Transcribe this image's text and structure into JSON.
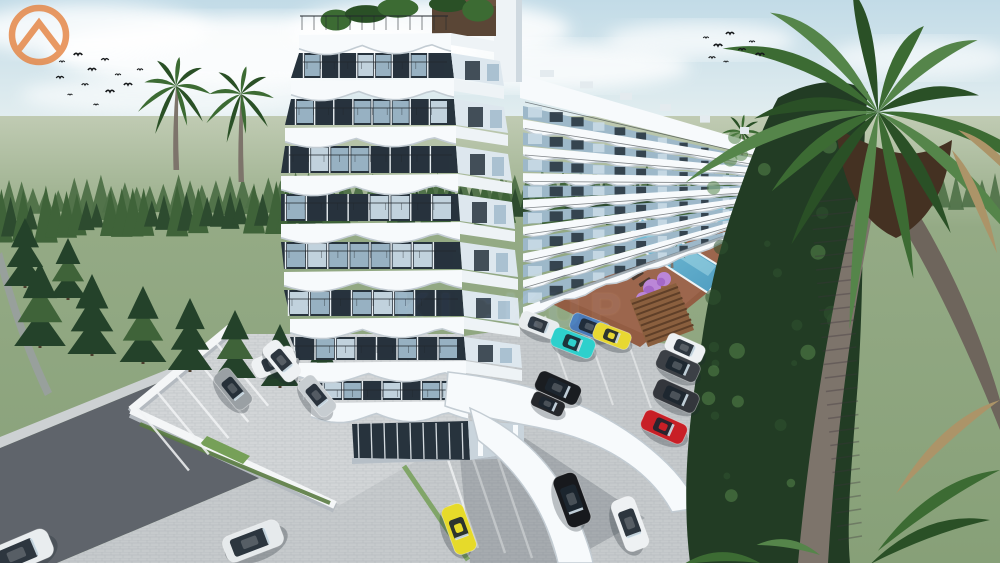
{
  "scene": {
    "description": "3D architectural rendering of a seaside apartment complex: curved white tower, long wing with wavy balconies, swimming pool with wooden deck, parking lots with cars, palm trees and pine forest",
    "watermark": {
      "text": "KICKUP",
      "icon": "chevron-house-circle-icon",
      "accent": "#e5813d"
    }
  },
  "colors": {
    "sky_top": "#c2dbe7",
    "sky_horizon": "#edf4f3",
    "cloud": "#ffffff",
    "field_far": "#c0cbb3",
    "field": "#94aa85",
    "field_deep": "#87a078",
    "forest_back": "#4e7047",
    "forest_front": "#2d4b2f",
    "conifer": "#24422a",
    "conifer_light": "#3f6339",
    "grass_patch": "#76a058",
    "hedge": "#5a7c42",
    "road": "#5f646b",
    "sidewalk": "#cdd1d3",
    "paver": "#c6cacc",
    "paver_light": "#d2d5d7",
    "line_white": "#f2f4f5",
    "wall": "#f4f6f7",
    "wall_shadow": "#b4bac0",
    "building_white": "#f7fafc",
    "slab_shadow": "#c3ccd3",
    "glass_dark": "#27333d",
    "glass_blue": "#9db8c9",
    "glass_light": "#c9dbe6",
    "mullion": "#e8eef2",
    "railing": "#22282d",
    "pent_brown": "#5a4636",
    "pool_water": "#7cc4da",
    "pool_deep": "#4e9cc0",
    "deck": "#935d43",
    "deck_light": "#a8705a",
    "lounger": "#4a3a30",
    "flower": "#bb86d8",
    "flower_deep": "#a468c8",
    "palm_green": "#3c6b33",
    "palm_dark": "#2a5026",
    "palm_light": "#55854a",
    "palm_skirt": "#443122",
    "palm_dry": "#ac9468",
    "trunk": "#7d746b",
    "trunk_gray": "#98a09c",
    "veg_dark": "#223c24",
    "veg_mid": "#2f5230",
    "shadow": "rgba(38,48,58,0.20)",
    "bird": "#15181a"
  },
  "buildings": {
    "tower": {
      "floors": 9,
      "style": "white curved slabs, wavy balconies, dark glazing"
    },
    "wing": {
      "floors": 8,
      "style": "long receding block with scalloped balcony fronts"
    }
  },
  "pool": {
    "shape": "diagonal lap pool",
    "loungers": 11,
    "flower_trees": 3
  },
  "cars": [
    {
      "n": "white-car-road",
      "c": "#eef1f3",
      "x": 274,
      "y": 362,
      "r": -23,
      "l": 44,
      "t": "sedan"
    },
    {
      "n": "white-van-corner",
      "c": "#e9edef",
      "x": 20,
      "y": 553,
      "r": -23,
      "l": 66,
      "t": "van"
    },
    {
      "n": "white-minivan",
      "c": "#e6eaec",
      "x": 253,
      "y": 541,
      "r": -21,
      "l": 60,
      "t": "van"
    },
    {
      "n": "gray-hatchback",
      "c": "#9aa0a4",
      "x": 233,
      "y": 389,
      "r": 51,
      "l": 44,
      "t": "sedan"
    },
    {
      "n": "white-suv-inner",
      "c": "#eef1f3",
      "x": 282,
      "y": 361,
      "r": 51,
      "l": 44,
      "t": "suv"
    },
    {
      "n": "silver-sedan-inner",
      "c": "#c7cdd1",
      "x": 317,
      "y": 396,
      "r": 51,
      "l": 44,
      "t": "sedan"
    },
    {
      "n": "white-wagon-mid",
      "c": "#e8ecee",
      "x": 539,
      "y": 325,
      "r": 21,
      "l": 40,
      "t": "suv"
    },
    {
      "n": "blue-sedan",
      "c": "#4a7ab8",
      "x": 590,
      "y": 327,
      "r": 21,
      "l": 40,
      "t": "sedan"
    },
    {
      "n": "cyan-supercar",
      "c": "#2ed0cc",
      "x": 573,
      "y": 343,
      "r": 21,
      "l": 44,
      "t": "supercar"
    },
    {
      "n": "yellow-supercar-mid",
      "c": "#e8d832",
      "x": 612,
      "y": 336,
      "r": 21,
      "l": 38,
      "t": "supercar"
    },
    {
      "n": "white-car-right",
      "c": "#eef1f3",
      "x": 685,
      "y": 348,
      "r": 24,
      "l": 40,
      "t": "sedan"
    },
    {
      "n": "darkgray-sedan",
      "c": "#3c4046",
      "x": 678,
      "y": 366,
      "r": 24,
      "l": 44,
      "t": "sedan"
    },
    {
      "n": "darkgray-suv",
      "c": "#33363c",
      "x": 676,
      "y": 396,
      "r": 24,
      "l": 46,
      "t": "suv"
    },
    {
      "n": "red-supercar",
      "c": "#c81f26",
      "x": 664,
      "y": 427,
      "r": 24,
      "l": 46,
      "t": "supercar"
    },
    {
      "n": "black-sedan",
      "c": "#1a1d21",
      "x": 558,
      "y": 388,
      "r": 24,
      "l": 46,
      "t": "sedan"
    },
    {
      "n": "dark-car-partial",
      "c": "#26282c",
      "x": 548,
      "y": 404,
      "r": 24,
      "l": 34,
      "t": "sedan"
    },
    {
      "n": "black-suv-front",
      "c": "#17191d",
      "x": 572,
      "y": 500,
      "r": 70,
      "l": 54,
      "t": "suv"
    },
    {
      "n": "white-suv-front",
      "c": "#eef1f3",
      "x": 630,
      "y": 524,
      "r": 70,
      "l": 54,
      "t": "suv"
    },
    {
      "n": "yellow-supercar-front",
      "c": "#e6da2a",
      "x": 459,
      "y": 529,
      "r": 70,
      "l": 50,
      "t": "supercar"
    }
  ],
  "birds": {
    "left": [
      [
        62,
        62
      ],
      [
        78,
        55
      ],
      [
        92,
        70
      ],
      [
        105,
        60
      ],
      [
        118,
        75
      ],
      [
        85,
        85
      ],
      [
        70,
        95
      ],
      [
        110,
        92
      ],
      [
        128,
        85
      ],
      [
        96,
        105
      ],
      [
        140,
        70
      ],
      [
        60,
        78
      ]
    ],
    "right": [
      [
        706,
        38
      ],
      [
        718,
        46
      ],
      [
        730,
        34
      ],
      [
        742,
        50
      ],
      [
        752,
        42
      ],
      [
        712,
        58
      ],
      [
        726,
        62
      ],
      [
        760,
        55
      ]
    ]
  }
}
